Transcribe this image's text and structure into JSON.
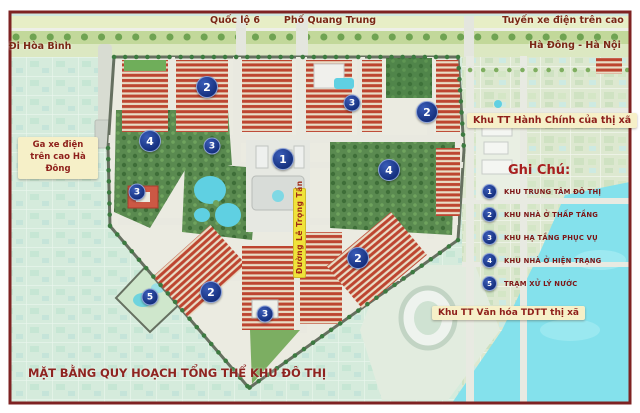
{
  "poster": {
    "title": "MẶT BẰNG QUY HOẠCH TỔNG THỂ KHU ĐÔ THỊ"
  },
  "roads": {
    "quoc_lo_6": "Quốc lộ 6",
    "pho_quang_trung": "Phố Quang Trung",
    "tuyen_xe_dien": "Tuyến xe điện trên cao",
    "di_hoa_binh": "Đi Hòa Bình",
    "ha_dong_ha_noi": "Hà Đông - Hà Nội",
    "duong_le_trong_tan": "Đường Lê Trọng Tấn"
  },
  "labels": {
    "ga_line1": "Ga xe điện",
    "ga_line2": "trên cao Hà Đông",
    "khu_tt_hanh_chinh": "Khu TT Hành Chính của thị xã",
    "khu_tt_van_hoa": "Khu TT Văn hóa TDTT thị xã"
  },
  "legend": {
    "heading": "Ghi Chú:",
    "items": [
      {
        "num": "1",
        "label": "KHU TRUNG TÂM ĐÔ THỊ"
      },
      {
        "num": "2",
        "label": "KHU NHÀ Ở THẤP TẦNG"
      },
      {
        "num": "3",
        "label": "KHU HẠ TẦNG PHỤC VỤ"
      },
      {
        "num": "4",
        "label": "KHU NHÀ Ở HIỆN TRẠNG"
      },
      {
        "num": "5",
        "label": "TRẠM XỬ LÝ NƯỚC"
      }
    ]
  },
  "markers": [
    "2",
    "3",
    "2",
    "4",
    "3",
    "1",
    "4",
    "3",
    "2",
    "2",
    "5",
    "3"
  ],
  "colors": {
    "frame": "#7e2222",
    "marker_blue": "#15307e",
    "label_cream": "#f6f0c8",
    "label_text": "#8e1f1a",
    "street_label_bg": "#f0e23a",
    "water_cyan": "#84e1ec",
    "housing_red": "#bd4530",
    "park_green": "#5a8a50"
  }
}
